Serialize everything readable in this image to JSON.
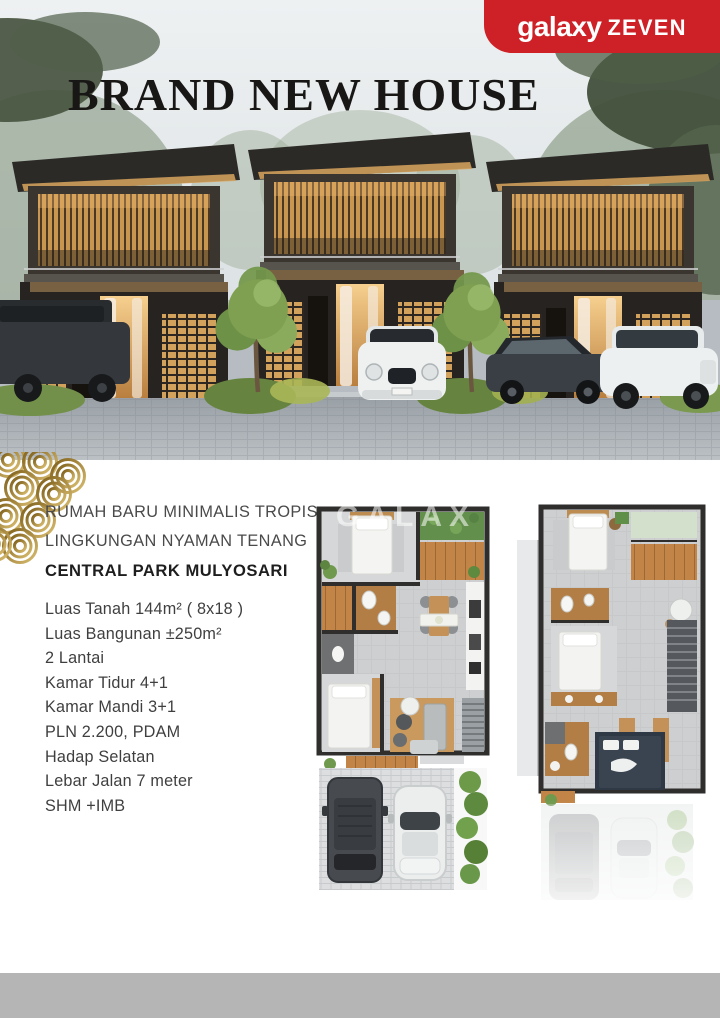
{
  "theme": {
    "brand_red": "#ce2127",
    "gold": "#a8842c",
    "title_color": "#181715",
    "footer_gray": "#b5b5b5"
  },
  "logo": {
    "brand": "galaxy",
    "suffix": "ZEVEN"
  },
  "hero": {
    "title": "BRAND NEW HOUSE"
  },
  "headline": {
    "line1": "RUMAH BARU MINIMALIS TROPIS",
    "line2": "LINGKUNGAN NYAMAN TENANG",
    "line3": "CENTRAL PARK MULYOSARI"
  },
  "specs": [
    "Luas Tanah 144m² ( 8x18 )",
    "Luas Bangunan ±250m²",
    "2 Lantai",
    "Kamar Tidur 4+1",
    "Kamar Mandi 3+1",
    "PLN 2.200, PDAM",
    "Hadap Selatan",
    "Lebar Jalan 7 meter",
    "SHM +IMB"
  ],
  "watermark": {
    "text": "GALAX"
  },
  "images": {
    "hero_photo": "three modern two-story tropical houses at dusk with cars parked in front",
    "floorplan_1": "first-floor plan with carport and two cars",
    "floorplan_2": "second-floor plan with faded ground floor beneath"
  }
}
